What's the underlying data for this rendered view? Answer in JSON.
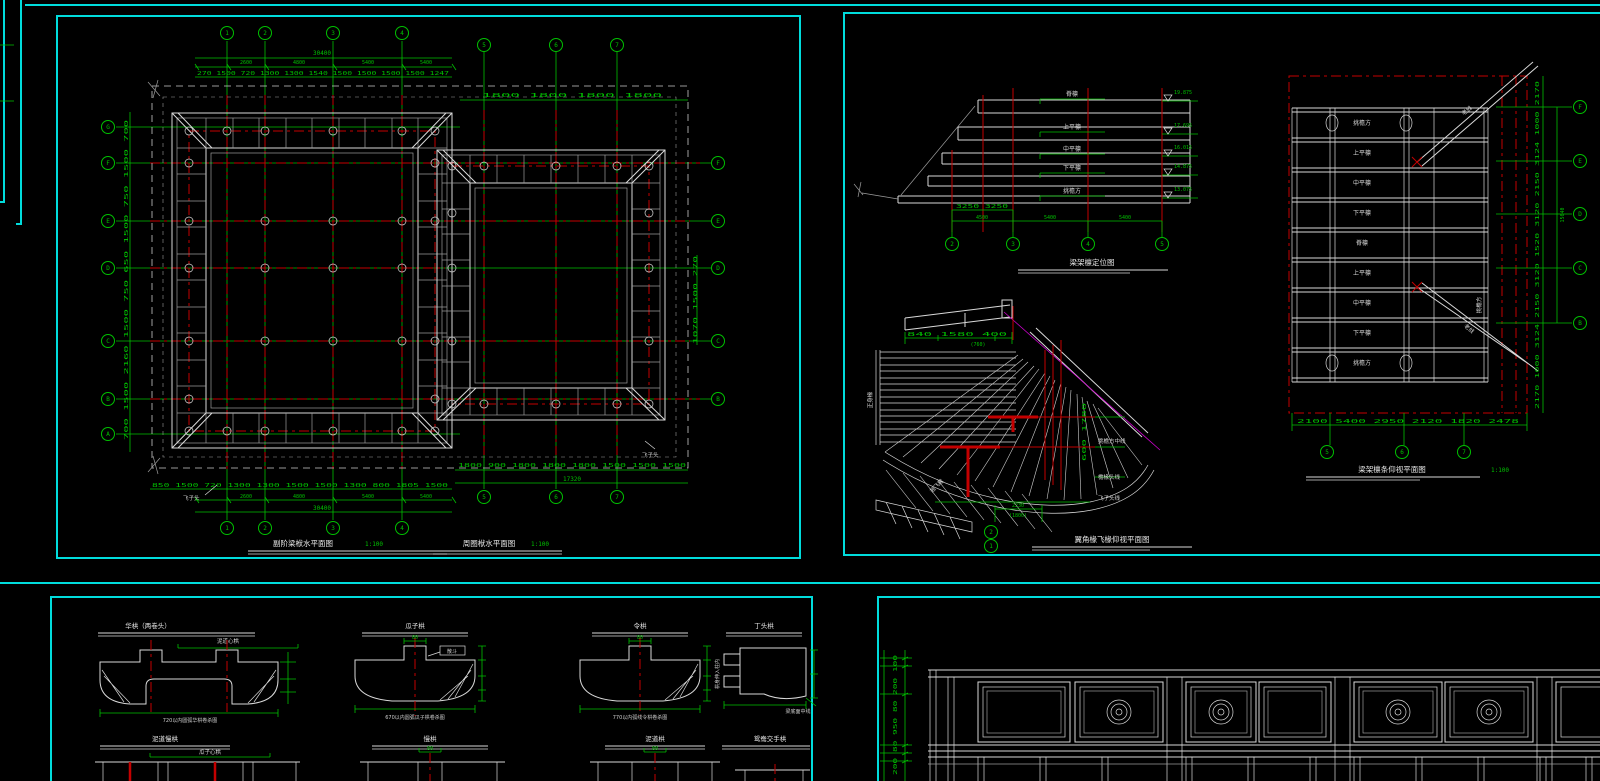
{
  "colors": {
    "background": "#000000",
    "viewport_frame": "#00dcdc",
    "grid_green": "#00c000",
    "centerline_red": "#c40000",
    "drawing_white": "#d9d9d9",
    "magenta": "#cc00cc"
  },
  "tl": {
    "title1": "副阶梁栿水平面图",
    "scale1": "1:100",
    "title2": "周圈栿水平面图",
    "scale2": "1:100",
    "cols": [
      "1",
      "2",
      "3",
      "4",
      "5",
      "6",
      "7"
    ],
    "rows_left": [
      "G",
      "F",
      "E",
      "D",
      "C",
      "B",
      "A"
    ],
    "rows_right": [
      "F",
      "E",
      "D",
      "C",
      "B"
    ],
    "dims_top_total": "30400",
    "dims_top_main": [
      "2600",
      "4800",
      "5400",
      "5400"
    ],
    "dims_top_sub": [
      "270",
      "1500",
      "720",
      "1300",
      "1300",
      "1540",
      "1500",
      "1500",
      "1500",
      "1500",
      "1247"
    ],
    "dims_top_right": [
      "1800",
      "1800",
      "1800",
      "1800"
    ],
    "dims_left": [
      "700",
      "1500",
      "2160",
      "1500",
      "750",
      "650",
      "1500",
      "750",
      "1500",
      "700"
    ],
    "dims_right_stub": [
      "1070",
      "1500",
      "270"
    ],
    "dims_bottom_sub": [
      "850",
      "1500",
      "720",
      "1300",
      "1300",
      "1500",
      "1500",
      "1300",
      "800",
      "1805",
      "1500"
    ],
    "dims_bottom_main": [
      "2600",
      "4800",
      "5400",
      "5400"
    ],
    "dims_bottom_total": "30400",
    "dims_bottom_right": [
      "1800",
      "900",
      "1800",
      "1800",
      "1800",
      "1500",
      "1500",
      "1500"
    ],
    "dims_bottom_right_total": "17320",
    "label_feizitou": "飞子头"
  },
  "tr": {
    "section": {
      "title": "梁架檩定位图",
      "cols": [
        "2",
        "3",
        "4",
        "5"
      ],
      "dims_row1": [
        "3250",
        "3250"
      ],
      "dims_row2": [
        "4500",
        "5400",
        "5400"
      ],
      "levels": [
        {
          "label": "脊檩",
          "elev": "19.875"
        },
        {
          "label": "上平檩",
          "elev": "17.695"
        },
        {
          "label": "中平檩",
          "elev": "16.015"
        },
        {
          "label": "下平檩",
          "elev": "14.875"
        },
        {
          "label": "挑檐方",
          "elev": "13.075"
        }
      ]
    },
    "corner": {
      "title": "翼角椽飞椽仰视平面图",
      "dims_top": [
        "840",
        "1580",
        "400"
      ],
      "dim_top_paren": "(760)",
      "dim_bottom": "2230",
      "dim_bottom_paren": "(1800)",
      "bubbles": [
        "2",
        "1"
      ],
      "dims_side": [
        "600",
        "1780"
      ],
      "labels_right": [
        "挑檐方中线",
        "檐椽头线",
        "飞子头线"
      ],
      "label_left": "正身椽",
      "label_fan": "翘飞椽"
    },
    "plan": {
      "title": "梁架檩条仰视平面图",
      "scale": "1:100",
      "rows": [
        "挑檐方",
        "上平檩",
        "中平檩",
        "下平檩",
        "脊檩",
        "上平檩",
        "中平檩",
        "下平檩",
        "挑檐方"
      ],
      "cols": [
        "5",
        "6",
        "7"
      ],
      "rows_right": [
        "F",
        "E",
        "D",
        "C",
        "B"
      ],
      "dims_bottom": [
        "2100",
        "5400",
        "2950",
        "2120",
        "1820",
        "2478"
      ],
      "dims_right": [
        "2170",
        "1000",
        "3124",
        "2150",
        "3120",
        "1520",
        "3120",
        "2150",
        "3124",
        "1000",
        "2170"
      ],
      "dim_right_total": "15040",
      "diag_label": "老戗",
      "side_label": "挑檐方"
    }
  },
  "bl": {
    "details": [
      {
        "title": "华栱（两卷头）",
        "sub": "泥道心栱",
        "note": "720以内圆弧华栱卷杀图"
      },
      {
        "title": "瓜子栱",
        "sub": "散斗",
        "top_dim": "80",
        "note": "670以内圆弧瓜子栱卷杀图"
      },
      {
        "title": "令栱",
        "top_dim": "80",
        "note": "770以内弧线令栱卷杀图"
      },
      {
        "title": "丁头栱",
        "note": "梁底面中线",
        "side": "栱身伸入柱内"
      },
      {
        "title": "泥道慢栱",
        "sub": "瓜子心栱"
      },
      {
        "title": "慢栱",
        "top_dim": "80"
      },
      {
        "title": "泥道栱",
        "top_dim": "80"
      },
      {
        "title": "鸳鸯交手栱"
      }
    ]
  },
  "br": {
    "dims_left": [
      "200",
      "80",
      "950",
      "80",
      "200",
      "100"
    ]
  }
}
